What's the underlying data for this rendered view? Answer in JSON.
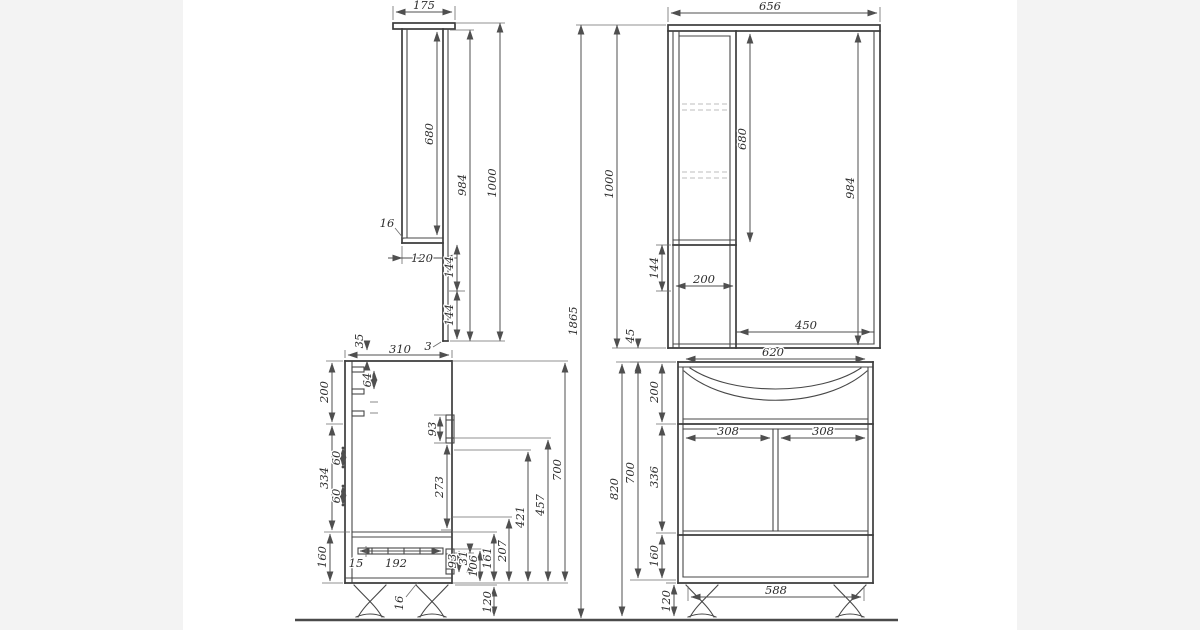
{
  "colors": {
    "background": "#ffffff",
    "margin_band": "#f3f3f3",
    "outline": "#3c3c3c",
    "dim_line": "#4f4f4f",
    "dashed_shelf": "#bdbdbd",
    "text": "#2e2e2e"
  },
  "views": {
    "mirror_side": {
      "dims": {
        "top_depth": "175",
        "door_opening": "680",
        "back_panel_height": "984",
        "total_height": "1000",
        "shelf_thickness": "16",
        "box_depth": "120",
        "offset_a": "144",
        "offset_b": "144",
        "panel_thickness": "3"
      }
    },
    "mirror_front": {
      "dims": {
        "total_width": "656",
        "total_height": "1000",
        "overall_height": "1865",
        "door_height": "680",
        "side_height": "984",
        "below_door": "144",
        "cabinet_width": "200",
        "mirror_width": "450",
        "mounting_gap": "45"
      }
    },
    "base_side": {
      "dims": {
        "hook_offset": "35",
        "hook_spacing": "64",
        "depth": "310",
        "top_section": "200",
        "door_section": "334",
        "drawer_section": "160",
        "hinge_offset_a": "60",
        "hinge_offset_b": "60",
        "door_handle_height": "93",
        "handle_to_bottom": "273",
        "handle_axis_a": "421",
        "handle_axis_b": "457",
        "body_height": "700",
        "slide_offset": "15",
        "slide_length": "192",
        "drawer_handle_height": "93",
        "detail_31": "31",
        "detail_106": "106",
        "detail_161": "161",
        "detail_207": "207",
        "leg_height": "120",
        "bottom_thickness": "16"
      }
    },
    "base_front": {
      "dims": {
        "top_width": "620",
        "basin_section": "200",
        "door_width_left": "308",
        "door_width_right": "308",
        "door_section": "336",
        "body_height": "700",
        "overall_height": "820",
        "drawer_section": "160",
        "leg_span": "588",
        "leg_height": "120"
      }
    }
  }
}
